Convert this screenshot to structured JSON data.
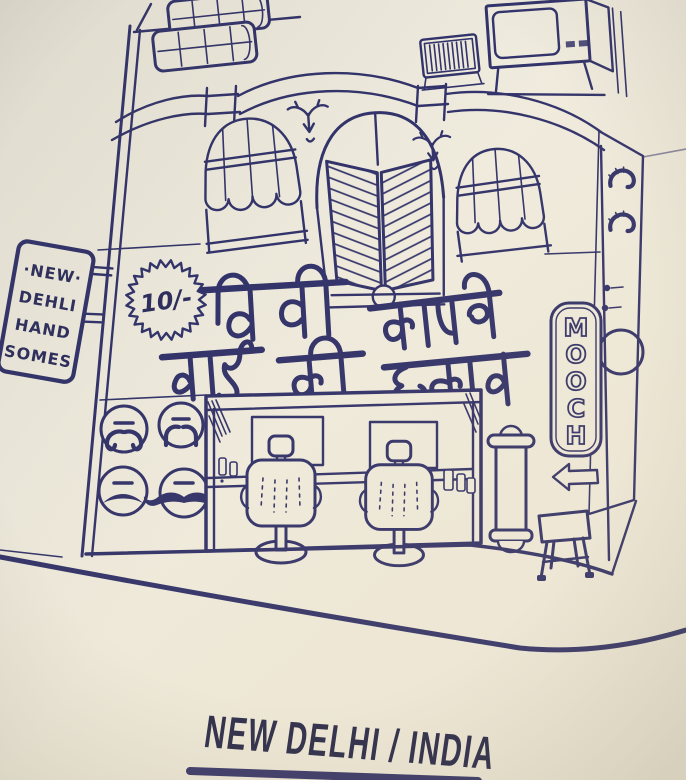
{
  "photo_caption": {
    "text": "NEW DELHI / INDIA"
  },
  "storefront": {
    "price_badge": "10/-",
    "hanging_sign_lines": [
      "·NEW·",
      "DEHLI",
      "HAND",
      "SOMES"
    ],
    "signboard_devanagari": {
      "line1": "मिशी कापणे",
      "line2": "नाई की दूकान"
    },
    "mooch_sign": {
      "word": "MOOCH",
      "letters": [
        "M",
        "O",
        "O",
        "C",
        "H"
      ]
    },
    "mustache_style_icons": [
      "curled-mustache",
      "horseshoe-mustache",
      "chevron-mustache",
      "handlebar-mustache"
    ],
    "colors": {
      "ink": "#31326b",
      "paper": "#f0ecdf",
      "caption_ink": "#23254a"
    }
  }
}
